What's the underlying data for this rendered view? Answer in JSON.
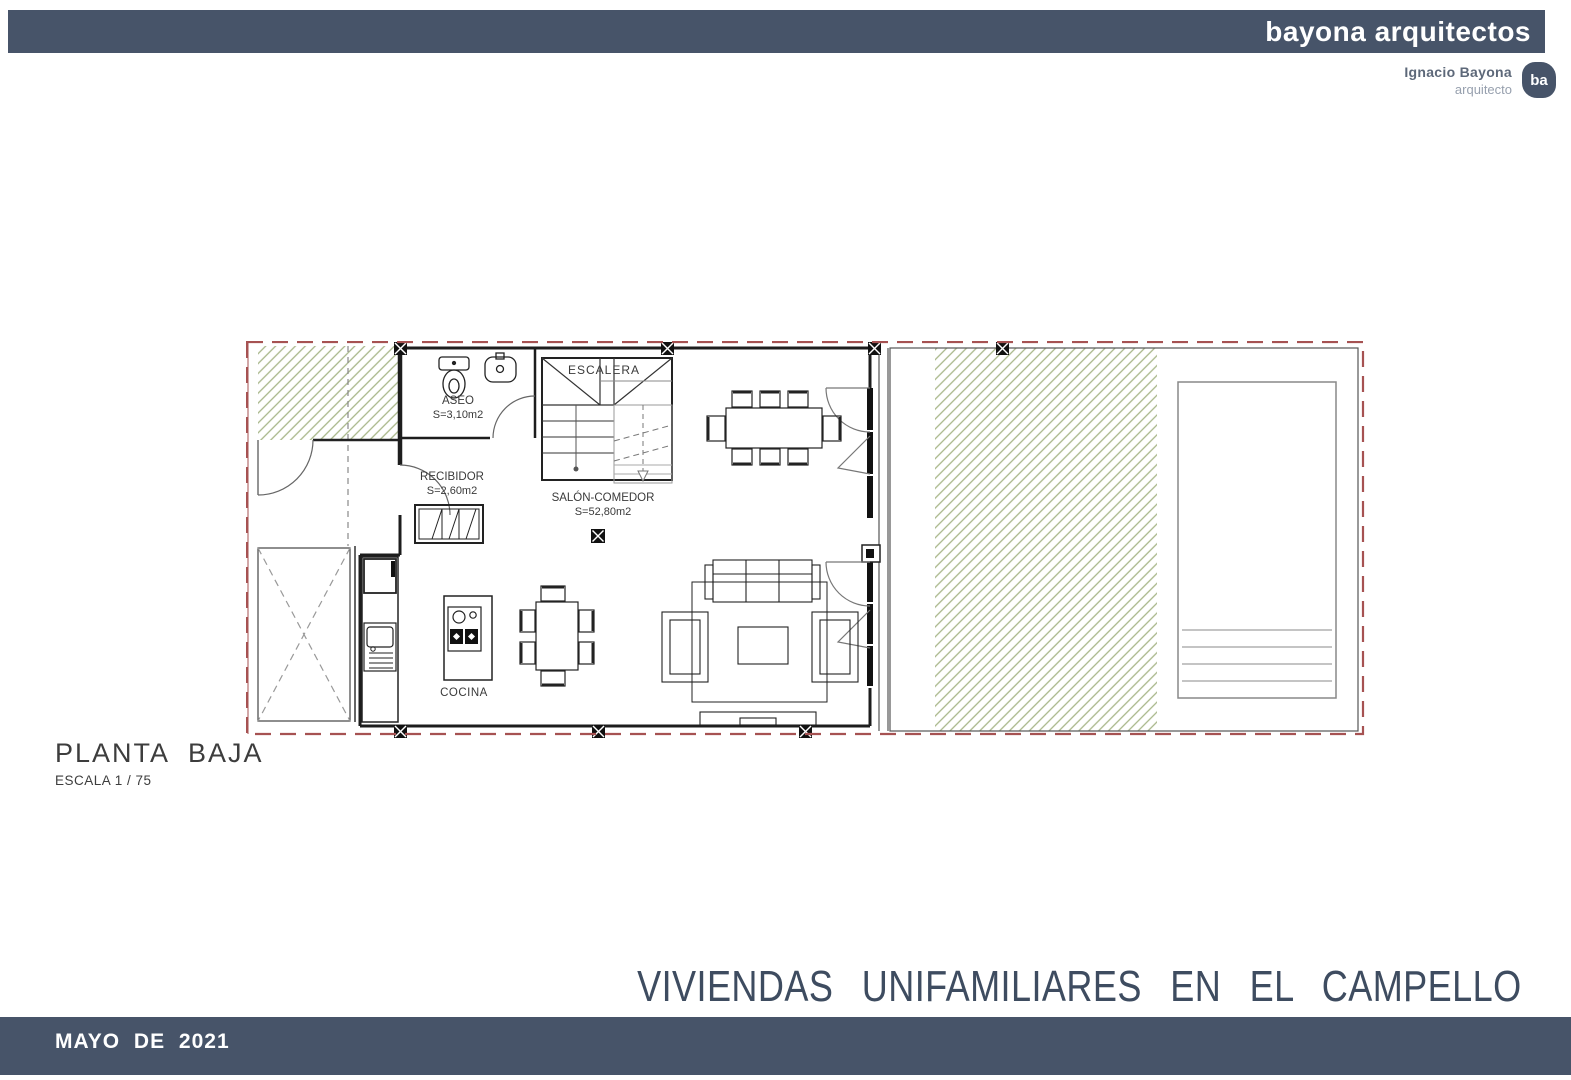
{
  "header": {
    "brand": "bayona arquitectos",
    "architect": {
      "name": "Ignacio Bayona",
      "role": "arquitecto",
      "badge": "ba"
    }
  },
  "plan": {
    "labels": {
      "escalera": "ESCALERA",
      "aseo": "ASEO",
      "aseo_area": "S=3,10m2",
      "recibidor": "RECIBIDOR",
      "recibidor_area": "S=2,60m2",
      "salon": "SALÓN-COMEDOR",
      "salon_area": "S=52,80m2",
      "cocina": "COCINA"
    }
  },
  "title_block": {
    "name": "PLANTA BAJA",
    "scale": "ESCALA 1 / 75"
  },
  "project_title": "VIVIENDAS UNIFAMILIARES EN EL CAMPELLO",
  "footer": {
    "date": "MAYO DE 2021"
  },
  "colors": {
    "accent": "#475469",
    "title": "#3e4c60",
    "boundary": "#a65252",
    "hatch": "#a8b689"
  }
}
